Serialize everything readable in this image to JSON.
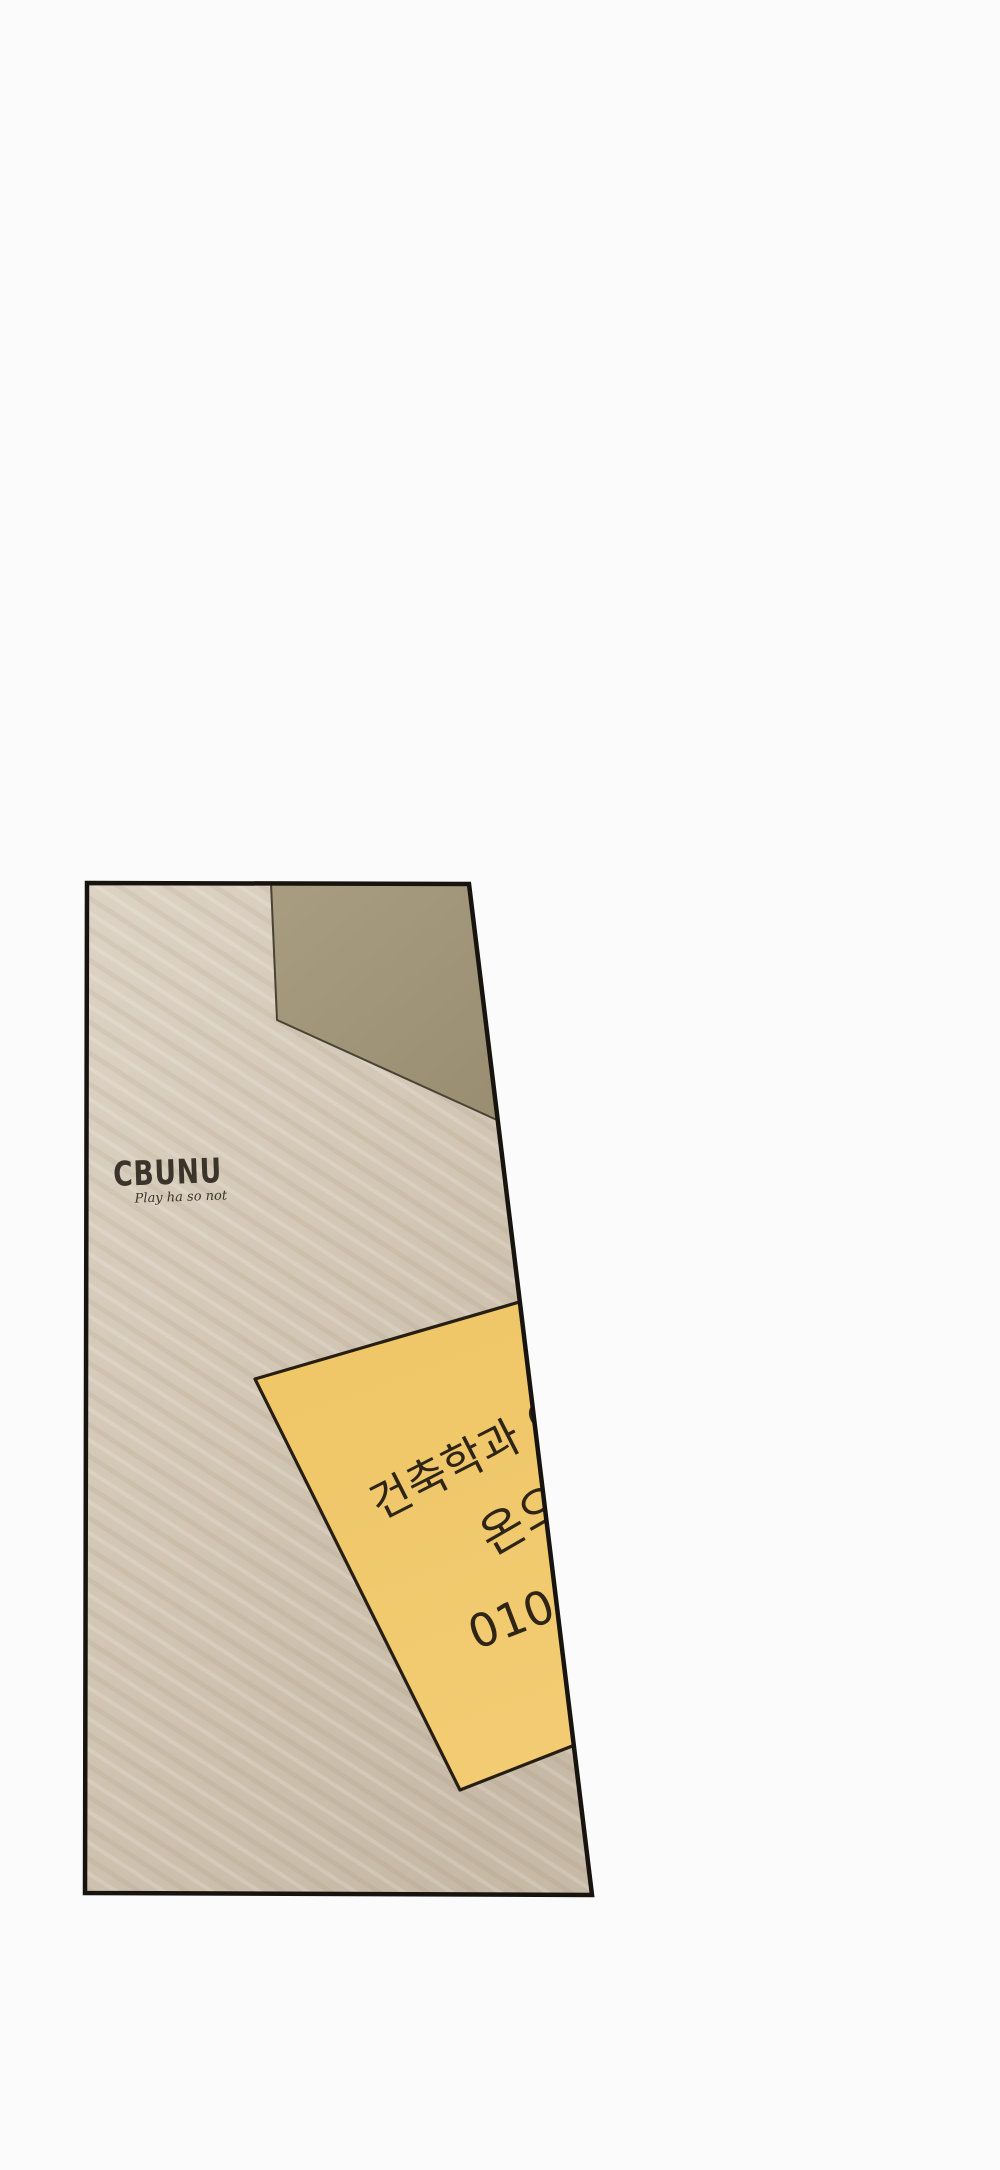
{
  "canvas": {
    "width": 1000,
    "height": 2170,
    "background": "#fbfbfb"
  },
  "panel": {
    "border_color": "#17130f",
    "wood": {
      "light": "#ddd3c5",
      "mid": "#d2c6b4",
      "dark": "#c6b9a5",
      "grain_dark": "rgba(138,118,92,0.10)",
      "grain_light": "rgba(255,252,246,0.18)"
    },
    "shadow_corner": {
      "light": "#a89d80",
      "dark": "#9a8f73",
      "edge_line": "#4a4334"
    }
  },
  "logo": {
    "name": "CBUNU",
    "tagline": "Play ha so not",
    "color": "#3b342b"
  },
  "sticky_note": {
    "fill_top": "#efc665",
    "fill_bottom": "#f2cb72",
    "border_color": "#261e12",
    "ink_color": "#2e2517",
    "lines": {
      "line1": "건축학과 이",
      "line2": "온으",
      "line3": "010-"
    }
  }
}
